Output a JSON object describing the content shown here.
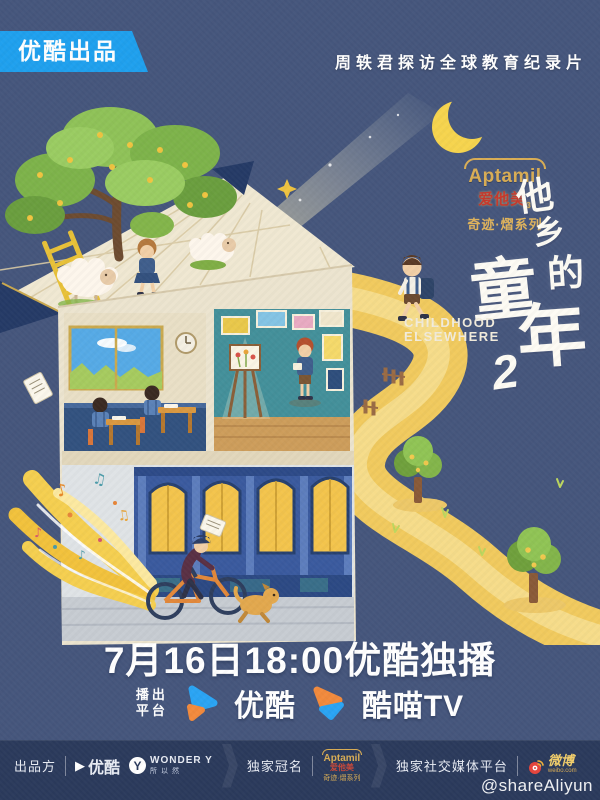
{
  "colors": {
    "background": "#45567c",
    "accent_blue": "#1fa0ee",
    "footer_bg": "#2b3a5c",
    "path_gold": "#f2cc63",
    "youku_blue": "#2aa4f4",
    "youku_orange": "#f28a3c",
    "weibo_red": "#e6443c",
    "aptamil_gold": "#d9ad55",
    "brand_red": "#cc3a2e",
    "title_white": "#ffffff"
  },
  "header": {
    "badge": "优酷出品",
    "tagline": "周轶君探访全球教育纪录片"
  },
  "sponsor_logo": {
    "brand": "Aptamil",
    "brand_cn": "爱他美",
    "brand_sub": "3",
    "series": "奇迹·熠系列"
  },
  "title": {
    "chars": [
      "他",
      "乡",
      "的",
      "童",
      "年"
    ],
    "season": "2",
    "en_line1": "CHILDHOOD",
    "en_line2": "ELSEWHERE"
  },
  "broadcast": {
    "date_line": "7月16日18:00优酷独播",
    "platform_label_line1": "播出",
    "platform_label_line2": "平台",
    "platforms": [
      {
        "name": "优酷",
        "icon": "youku-play-icon"
      },
      {
        "name": "酷喵TV",
        "icon": "kumiao-play-icon"
      }
    ]
  },
  "illustration": {
    "music_notes": [
      "♪",
      "♫",
      "♪",
      "♫",
      "♪"
    ]
  },
  "footer": {
    "producer_label": "出品方",
    "producer_icon_glyph": "▶",
    "producer_name": "优酷",
    "wonder_icon_letter": "Y",
    "wonder_brand": "WONDER Y",
    "wonder_sub": "所以然",
    "naming_label": "独家冠名",
    "naming_brand": "Aptamil",
    "naming_brand_cn": "爱他美",
    "naming_series": "奇迹·熠系列",
    "social_label": "独家社交媒体平台",
    "social_brand": "微博",
    "social_brand_sub": "weibo.com",
    "watermark": "@shareAliyun"
  }
}
